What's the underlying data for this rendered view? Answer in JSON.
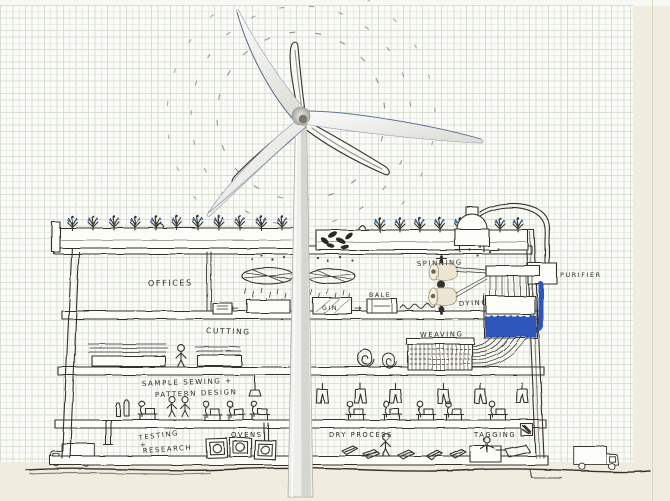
{
  "scene": {
    "description": "Hand-drawn cross-section sketch of a wind-powered textile factory on graph paper, with a photographic three-blade wind turbine overlaid in front",
    "top_floor_areas": [
      "OFFICES",
      "GIN",
      "BALE",
      "SPINNING",
      "DYING",
      "PURIFIER"
    ],
    "middle_floor_areas": [
      "CUTTING",
      "WEAVING"
    ],
    "lower_floor_areas": [
      "SAMPLE SEWING + PATTERN DESIGN"
    ],
    "ground_floor_areas": [
      "TESTING + RESEARCH",
      "OVENS",
      "DRY PROCESS",
      "TAGGING"
    ]
  },
  "labels": {
    "offices": "OFFICES",
    "cutting": "CUTTING",
    "gin": "GIN",
    "bale": "BALE",
    "spinning": "SPINNING",
    "dying": "DYING",
    "weaving": "WEAVING",
    "purifier": "PURIFIER",
    "sample_sewing_line1": "SAMPLE SEWING +",
    "sample_sewing_line2": "PATTERN DESIGN",
    "testing_line1": "TESTING",
    "testing_line2": "+",
    "testing_line3": "RESEARCH",
    "ovens": "OVENS",
    "dry_process": "DRY PROCESS",
    "tagging": "TAGGING"
  },
  "arrows": {
    "to_bale": "→",
    "to_offices": "←"
  },
  "icons": {
    "wind-turbine": "white three-blade turbine photo with sketched ghost blades and dashed motion arcs",
    "roof-garden": "planter boxes with plants and blue flowers along both roof sections",
    "ceiling-fans": "two fan ellipses with cotton falling below",
    "spinning-bobbins": "two cream thread bobbins on a vertical spindle",
    "dye-tank": "tank half-filled with blue dye fed by a blue pipe",
    "purifier-pipe": "pipe from roof machine into purifier box then blue pipe to tank",
    "loom": "weaving loom receiving curved dyed threads from the tank",
    "fabric-stacks": "piles of fabric in the cutting room",
    "hanging-garments": "row of trousers hanging from the ceiling",
    "sewing-stations": "workers seated at sewing machines",
    "ovens": "three oven boxes with round doors",
    "dry-process-items": "fabric pieces laid out with a worker",
    "tagging-station": "worker at booth attaching a large tag",
    "delivery-truck-left": "truck at lower left facing left",
    "delivery-truck-right": "truck at lower right facing right",
    "scribbled-word": "illegible scribbled word between BALE and the spindle"
  },
  "colors": {
    "ink": "#35332c",
    "accent_blue": "#2d57bb",
    "paper": "#fbfbf7",
    "grid_line": "#d7dfd5",
    "margin": "#f0ecdf",
    "turbine_white": "#f6f6f3"
  }
}
